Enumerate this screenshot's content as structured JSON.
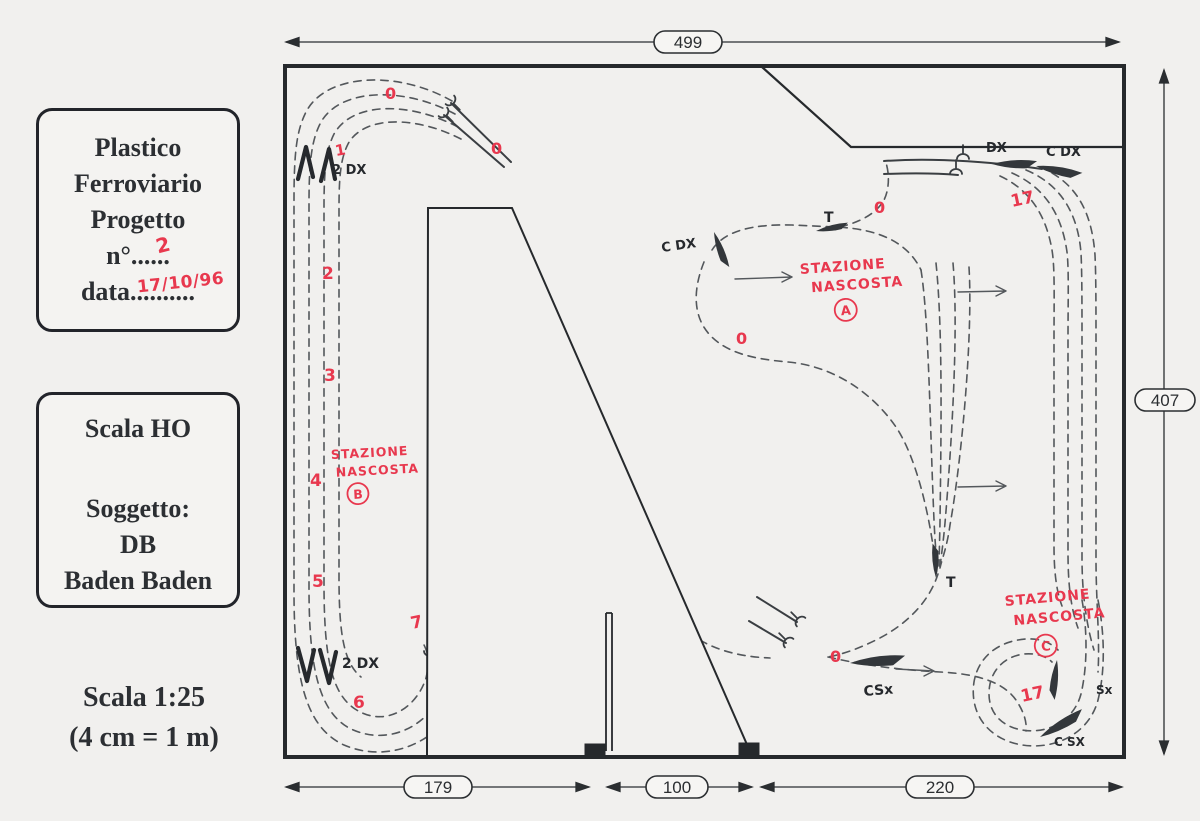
{
  "colors": {
    "paper": "#f1f0ee",
    "ink": "#2b2e31",
    "track": "#53575b",
    "red": "#e8384e"
  },
  "cards": {
    "project": {
      "line1": "Plastico",
      "line2": "Ferroviario",
      "line3": "Progetto",
      "number_line": "n°......",
      "number_value": "2",
      "date_line": "data..........",
      "date_value": "17/10/96"
    },
    "subject": {
      "scale": "Scala HO",
      "subject_label": "Soggetto:",
      "subject_line1": "DB",
      "subject_line2": "Baden Baden"
    }
  },
  "scale_note": {
    "line1": "Scala  1:25",
    "line2": "(4 cm = 1 m)"
  },
  "dims": {
    "top": "499",
    "right": "407",
    "bottom_left": "179",
    "bottom_middle": "100",
    "bottom_right": "220"
  },
  "labels": {
    "tl_switch": "2 DX",
    "bl_switch": "2 DX",
    "mid_cdx": "C DX",
    "t_top": "T",
    "t_bottom": "T",
    "tr_dx": "DX",
    "tr_cdx": "C DX",
    "csx": "CSx",
    "sx": "Sx",
    "br_csx": "C SX"
  },
  "numbers": [
    "1",
    "2",
    "3",
    "4",
    "5",
    "6",
    "7"
  ],
  "seventeen": "17",
  "zero": "0",
  "stations": {
    "a": {
      "line1": "STAZIONE",
      "line2": "NASCOSTA",
      "letter": "A"
    },
    "b": {
      "line1": "STAZIONE",
      "line2": "NASCOSTA",
      "letter": "B"
    },
    "c": {
      "line1": "STAZIONE",
      "line2": "NASCOSTA",
      "letter": "C"
    }
  }
}
